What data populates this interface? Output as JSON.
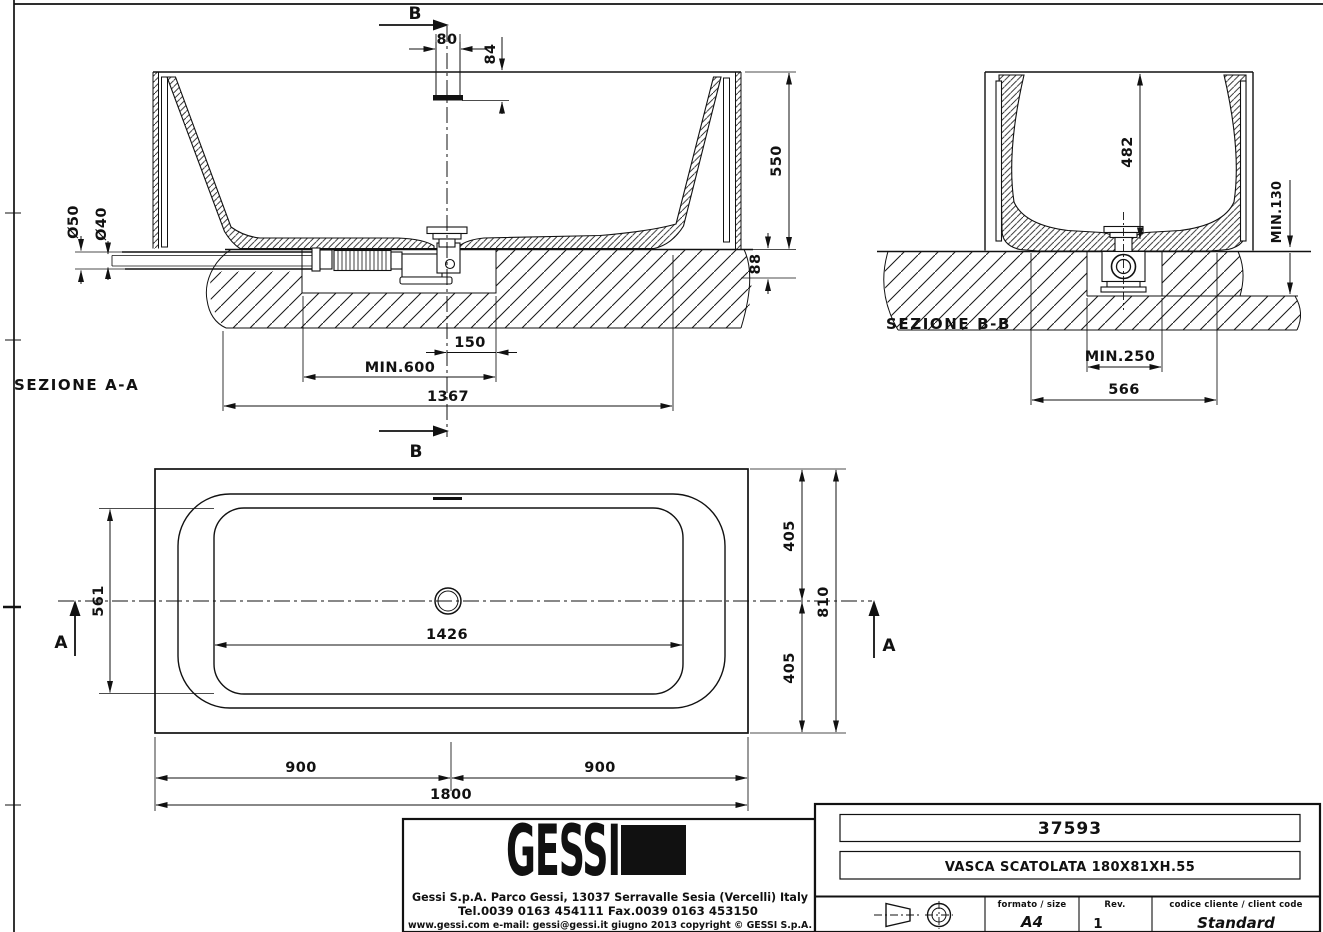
{
  "colors": {
    "ink": "#111111",
    "paper": "#ffffff"
  },
  "section_aa": {
    "name": "SEZIONE  A-A",
    "cut_top": "B",
    "cut_bottom": "B",
    "dim_pipe_width": "80",
    "dim_pipe_height": "84",
    "dim_height": "550",
    "dim_deck_thickness": "88",
    "dim_drain_outer": "Ø50",
    "dim_drain_inner": "Ø40",
    "dim_drain_offset": "150",
    "dim_recess_min": "MIN.600",
    "dim_length": "1367"
  },
  "section_bb": {
    "name": "SEZIONE  B-B",
    "dim_depth": "482",
    "dim_recess_depth": "MIN.130",
    "dim_recess_width": "MIN.250",
    "dim_base_width": "566"
  },
  "plan": {
    "cut_left": "A",
    "cut_right": "A",
    "dim_basin_width": "561",
    "dim_basin_length": "1426",
    "dim_half_width_top": "405",
    "dim_half_width_bottom": "405",
    "dim_width": "810",
    "dim_half_length_left": "900",
    "dim_half_length_right": "900",
    "dim_length": "1800"
  },
  "title_block": {
    "logo": "GESSI",
    "address": "Gessi  S.p.A.  Parco  Gessi,  13037  Serravalle  Sesia  (Vercelli)  Italy",
    "phone": "Tel.0039  0163  454111  Fax.0039  0163  453150",
    "web": "www.gessi.com   e-mail:  gessi@gessi.it      giugno  2013      copyright © GESSI  S.p.A.",
    "article_code": "37593",
    "description": "VASCA SCATOLATA 180X81XH.55",
    "format_label": "formato / size",
    "format_value": "A4",
    "rev_label": "Rev.",
    "rev_value": "1",
    "client_label": "codice cliente / client code",
    "client_value": "Standard"
  }
}
